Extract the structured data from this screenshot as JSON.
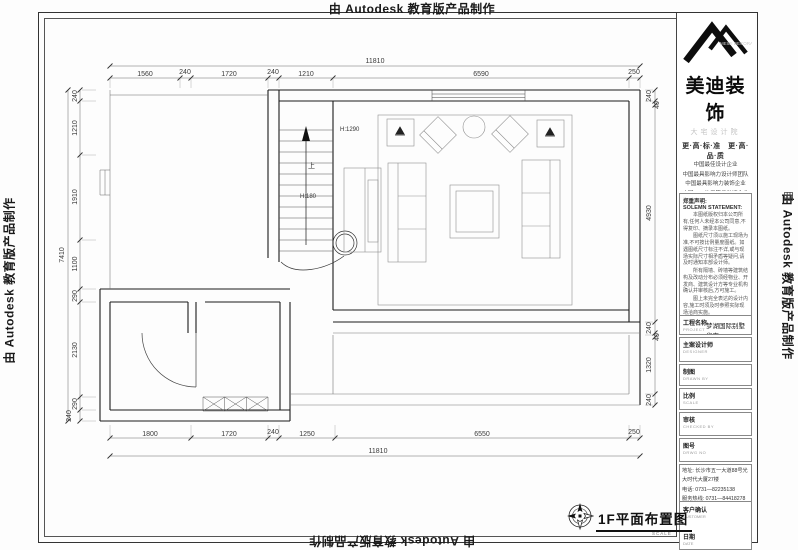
{
  "edge": {
    "top": "由 Autodesk 教育版产品制作",
    "bottom": "由 Autodesk 教育版产品制作",
    "left": "由 Autodesk 教育版产品制作",
    "right": "由 Autodesk 教育版产品制作"
  },
  "brand": {
    "name": "美迪装饰",
    "name_en": "MEIDI DECORATION",
    "institute": "大宅设计院",
    "slogan": "更·高·标·准　更·高·品·质",
    "accolades": [
      "中国最佳设计企业",
      "中国最具影响力设计师团队",
      "中国最具影响力装饰企业",
      "中国AAA信用等级装饰企业",
      "中国装饰装修示范工程奖企业",
      "中国最佳装饰精品质量奖企业"
    ]
  },
  "statement": {
    "title": "郑重声明:",
    "title_en": "SOLEMN STATEMENT:",
    "paragraphs": [
      "本图纸版权归本公司所有,任何人未经本公司同意,不得复印、摘录本图纸。",
      "图纸尺寸须以施工现场为准,不可按比例量度图纸。如遇图纸尺寸标注不详,或与现场实际尺寸相矛盾等疑问,请及时通知本部设计师。",
      "所有隔墙、砖墙等建筑结构及改动分布必须经物业、开发商、建筑设计方等专业机构确认并审核后,方可施工。",
      "图上未完全表达的设计内容,施工时须及时参照实际现场洽商实施。",
      "如工程未在本公司施工(含未施工项目),以后出现的一切质量问题与本公司无关。"
    ]
  },
  "title_block": {
    "project": {
      "label": "工程名称",
      "sub": "PROJECT",
      "value": "梦湖国际别墅华宅"
    },
    "designer": {
      "label": "主案设计师",
      "sub": "DESIGNER",
      "value": ""
    },
    "drawn": {
      "label": "制图",
      "sub": "DRAWN BY",
      "value": ""
    },
    "scale": {
      "label": "比例",
      "sub": "SCALE",
      "value": ""
    },
    "checked": {
      "label": "审核",
      "sub": "CHECKED BY",
      "value": ""
    },
    "number": {
      "label": "图号",
      "sub": "DRWG NO",
      "value": ""
    },
    "address_lines": [
      "地址: 长沙市五一大道88号光大时代大厦27楼",
      "电话: 0731—82235138",
      "服务热线: 0731—84418278"
    ],
    "customer": {
      "label": "客户确认",
      "sub": "CUSTOMER",
      "date_label": "日期",
      "date_sub": "DATE"
    }
  },
  "plan": {
    "title": "1F平面布置图",
    "scale_caption": "SCALE",
    "labels": {
      "h1": "H:1290",
      "h2": "H:180",
      "up": "上"
    }
  },
  "dims": {
    "top_total": "11810",
    "top": [
      "1560",
      "240",
      "1720",
      "240",
      "1210",
      "6590",
      "250"
    ],
    "bottom": [
      "1800",
      "1720",
      "240",
      "1250",
      "6550",
      "250"
    ],
    "bottom_total": "11810",
    "left_total": "7410",
    "left": [
      "240",
      "1210",
      "1910",
      "1100",
      "290",
      "2130",
      "290",
      "240"
    ],
    "right": [
      "240",
      "40",
      "4930",
      "240",
      "40",
      "1320",
      "240"
    ]
  }
}
